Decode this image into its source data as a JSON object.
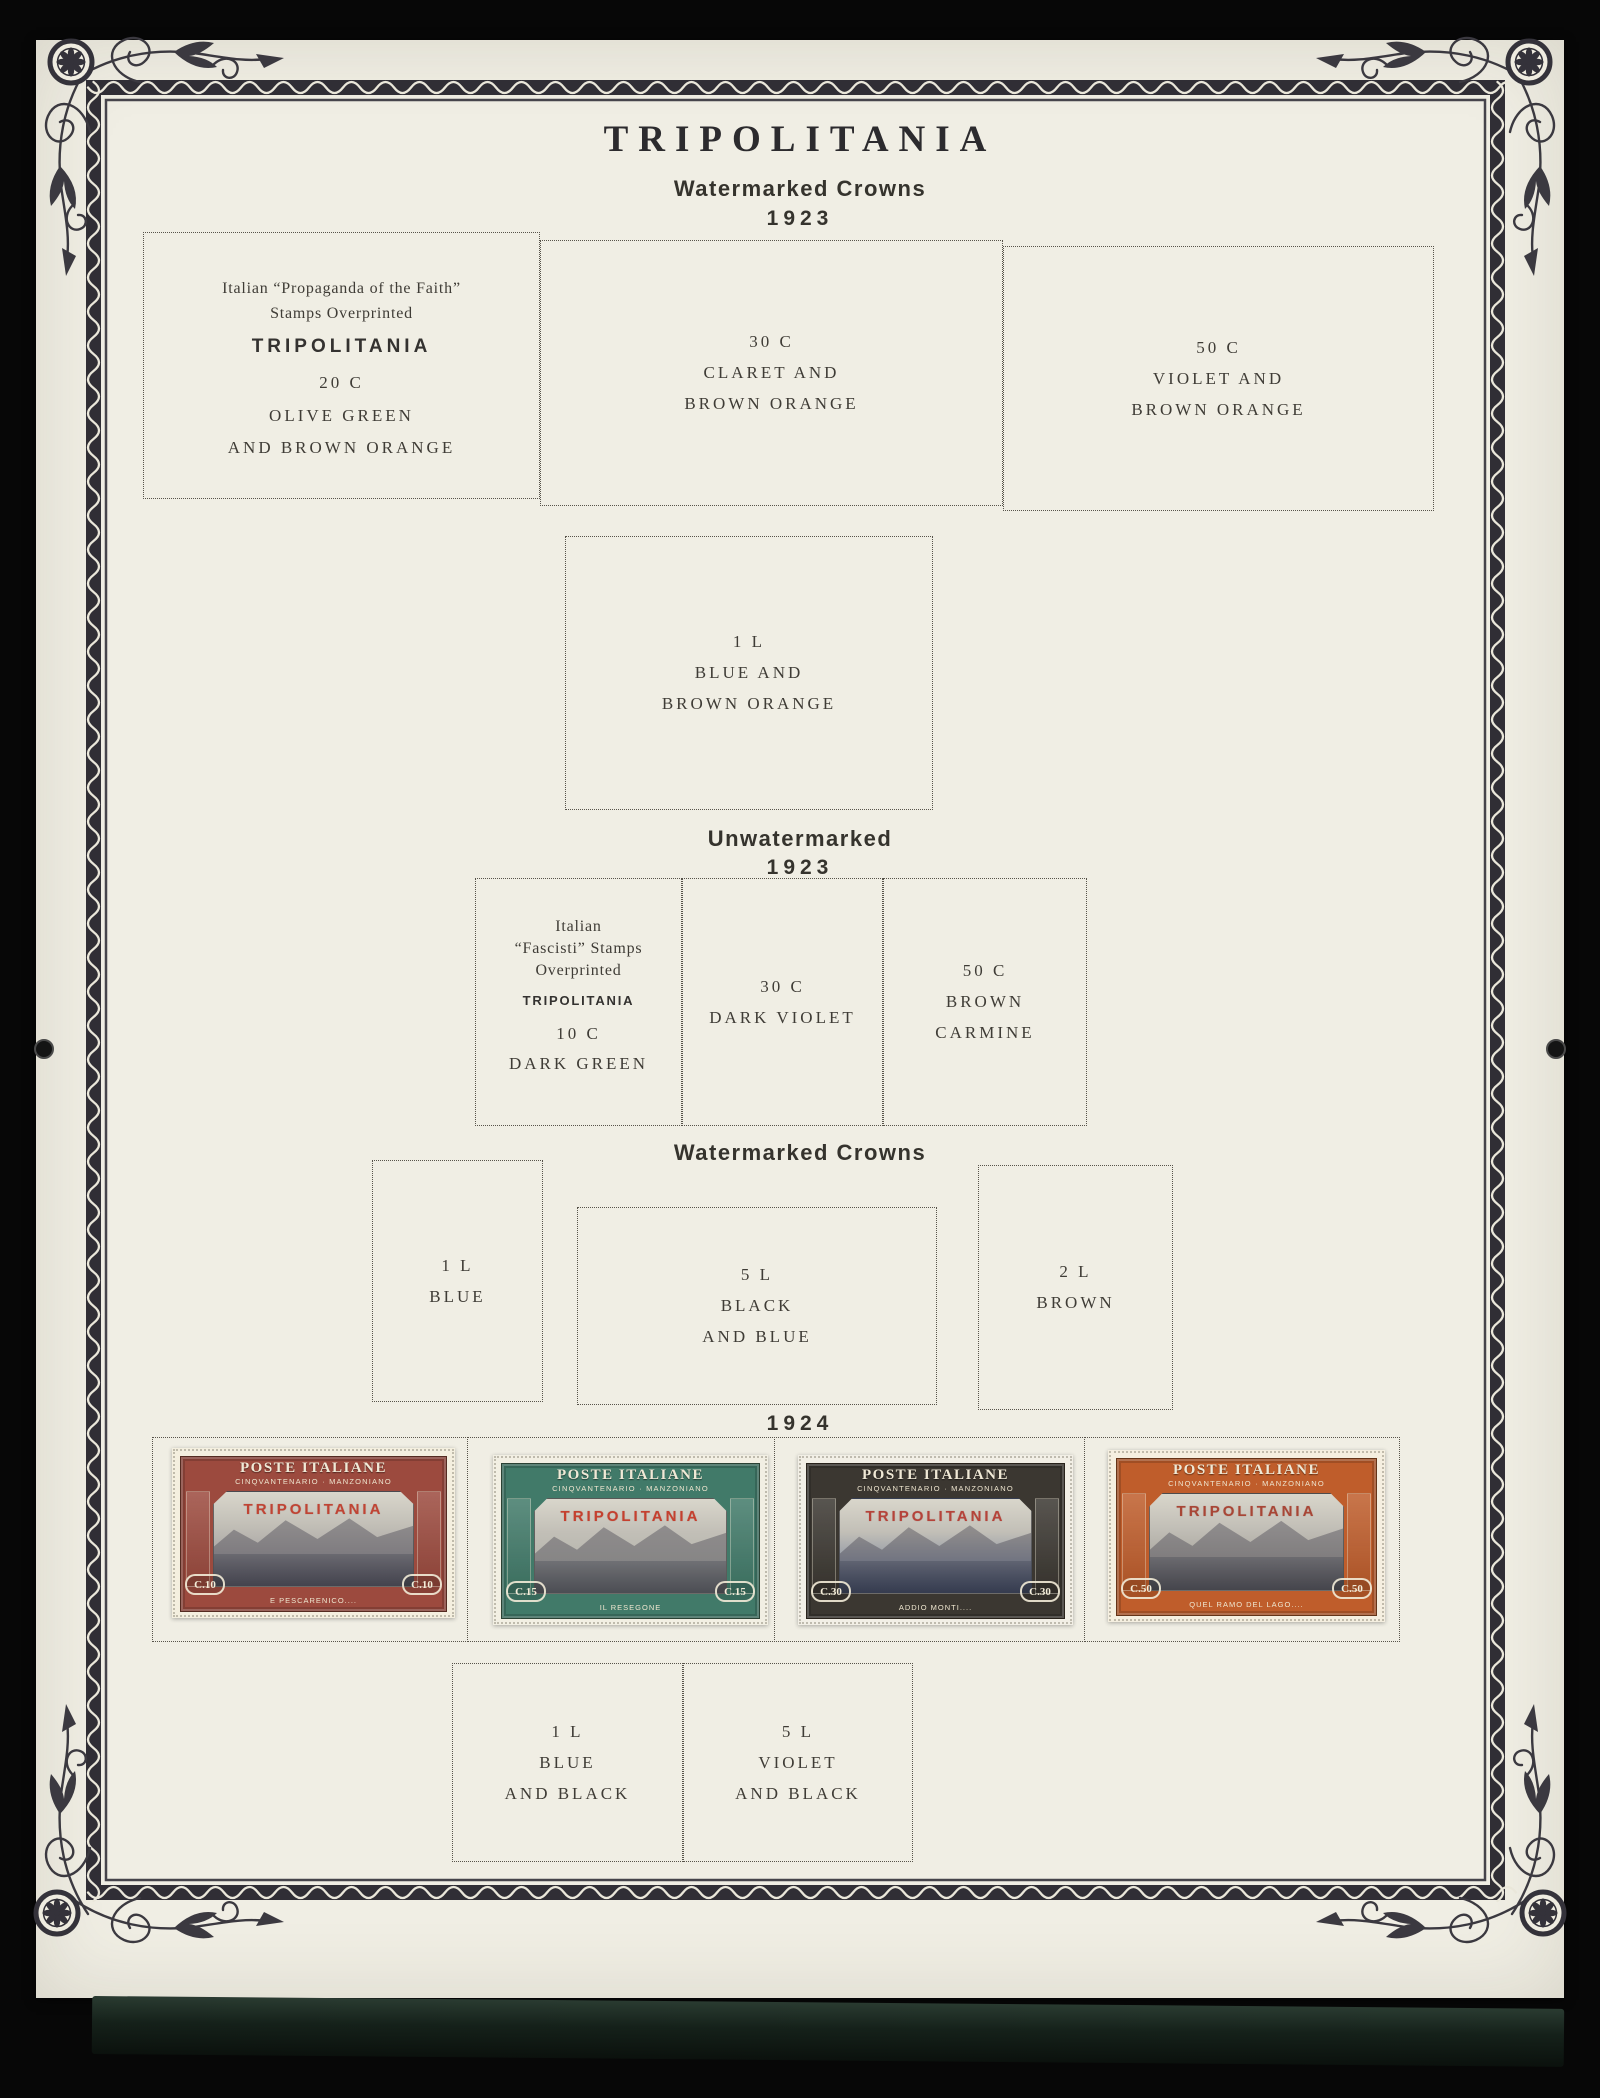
{
  "page_title": "TRIPOLITANIA",
  "headings": {
    "watermarked_1": "Watermarked Crowns",
    "year_1": "1923",
    "unwatermarked": "Unwatermarked",
    "year_2": "1923",
    "watermarked_2": "Watermarked Crowns",
    "year_3": "1924"
  },
  "placeholder_rows": {
    "row1": [
      {
        "lines": [
          "Italian “Propaganda of the Faith”",
          "Stamps Overprinted",
          "TRIPOLITANIA",
          "20 C",
          "OLIVE GREEN",
          "AND BROWN ORANGE"
        ]
      },
      {
        "lines": [
          "30 C",
          "CLARET AND",
          "BROWN ORANGE"
        ]
      },
      {
        "lines": [
          "50 C",
          "VIOLET AND",
          "BROWN ORANGE"
        ]
      }
    ],
    "row1_single": {
      "lines": [
        "1 L",
        "BLUE AND",
        "BROWN ORANGE"
      ]
    },
    "row2": [
      {
        "lines": [
          "Italian",
          "“Fascisti” Stamps",
          "Overprinted",
          "TRIPOLITANIA",
          "10 C",
          "DARK GREEN"
        ]
      },
      {
        "lines": [
          "30 C",
          "DARK VIOLET"
        ]
      },
      {
        "lines": [
          "50 C",
          "BROWN",
          "CARMINE"
        ]
      }
    ],
    "row3": [
      {
        "lines": [
          "1 L",
          "BLUE"
        ]
      },
      {
        "lines": [
          "5 L",
          "BLACK",
          "AND BLUE"
        ]
      },
      {
        "lines": [
          "2 L",
          "BROWN"
        ]
      }
    ],
    "row4": [
      {
        "lines": [
          "1 L",
          "BLUE",
          "AND BLACK"
        ]
      },
      {
        "lines": [
          "5 L",
          "VIOLET",
          "AND BLACK"
        ]
      }
    ]
  },
  "stamps": [
    {
      "title": "POSTE ITALIANE",
      "series": "CINQVANTENARIO · MANZONIANO",
      "overprint": "TRIPOLITANIA",
      "value": "C.10",
      "caption": "E PESCARENICO....",
      "colors": {
        "frame": "#9c4a3e",
        "vignette": "#8e8a90",
        "paper": "#f4efdf",
        "overprint_ink": "#c04434"
      }
    },
    {
      "title": "POSTE ITALIANE",
      "series": "CINQVANTENARIO · MANZONIANO",
      "overprint": "TRIPOLITANIA",
      "value": "C.15",
      "caption": "IL RESEGONE",
      "colors": {
        "frame": "#417a69",
        "vignette": "#a9aca3",
        "paper": "#f2efe3",
        "overprint_ink": "#c5402f"
      }
    },
    {
      "title": "POSTE ITALIANE",
      "series": "CINQVANTENARIO · MANZONIANO",
      "overprint": "TRIPOLITANIA",
      "value": "C.30",
      "caption": "ADDIO MONTI....",
      "colors": {
        "frame": "#3b3731",
        "vignette": "#5d6f94",
        "paper": "#f2efe6",
        "overprint_ink": "#b5433a"
      }
    },
    {
      "title": "POSTE ITALIANE",
      "series": "CINQVANTENARIO · MANZONIANO",
      "overprint": "TRIPOLITANIA",
      "value": "C.50",
      "caption": "QUEL RAMO DEL LAGO....",
      "colors": {
        "frame": "#bf5d2b",
        "vignette": "#93908a",
        "paper": "#f5efe0",
        "overprint_ink": "#a84636"
      }
    }
  ]
}
